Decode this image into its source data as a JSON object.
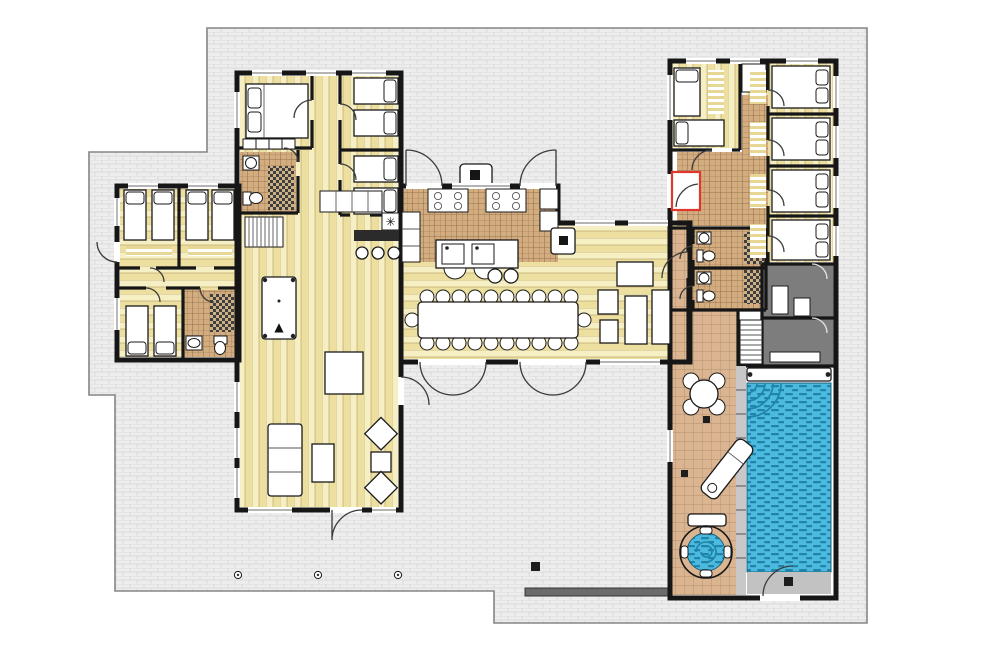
{
  "meta": {
    "title": "holiday-villa-floor-plan",
    "canvas_width": 1000,
    "canvas_height": 666
  },
  "colors": {
    "page_bg": "#ffffff",
    "terrace": "#ededed",
    "terrace_line": "#d7d7d7",
    "terrace_border": "#858585",
    "wall": "#161616",
    "room_bg": "#ffffff",
    "wood_light": "#f7efc4",
    "wood_dark": "#ecdf9f",
    "wood_line": "#b9a76a",
    "tile_base": "#d3ac80",
    "tile_line": "#96754d",
    "deck_base": "#dbb591",
    "deck_line": "#a8835f",
    "check_dark": "#3f3f3f",
    "check_light": "#cdb184",
    "dark_room": "#7d7d7d",
    "pool_base": "#4cb9de",
    "pool_wave": "#1f84a8",
    "pool_rim": "#c8c8c8",
    "platform": "#c2c2c2",
    "accent_red": "#e0372c",
    "furniture": "#ffffff",
    "furniture_line": "#1a1a1a",
    "bar_dark": "#2b2b2b",
    "wall_bar": "#6b6b6b",
    "rug_stripe": "#e6d794"
  },
  "glyphs": {
    "stove": "✳",
    "billiard_rack": "▲"
  },
  "legend": {
    "areas": [
      "paved-terrace",
      "west-bedroom-wing",
      "central-bedrooms",
      "central-bathroom",
      "living-room",
      "billiard-corner",
      "bar-corner",
      "kitchen",
      "dining-room",
      "lounge-corner",
      "east-bedroom-wing",
      "entry-hall",
      "bathrooms",
      "sauna-rooms",
      "pool-deck",
      "swimming-pool",
      "hot-tub"
    ],
    "fixtures": [
      "single-bed",
      "double-bed",
      "pillow",
      "striped-rug",
      "wardrobe",
      "sink",
      "toilet",
      "shower",
      "stairs",
      "bar-counter",
      "bar-stool",
      "billiard-table",
      "sofa",
      "armchair",
      "coffee-table",
      "dining-table",
      "dining-chair",
      "cooktop",
      "kitchen-island",
      "kitchen-sink",
      "fridge",
      "stove",
      "bbq-grill",
      "round-table",
      "lounge-chair",
      "pool-cover-roller",
      "pool-steps",
      "hot-tub-seat",
      "garden-post",
      "garden-wall"
    ]
  }
}
